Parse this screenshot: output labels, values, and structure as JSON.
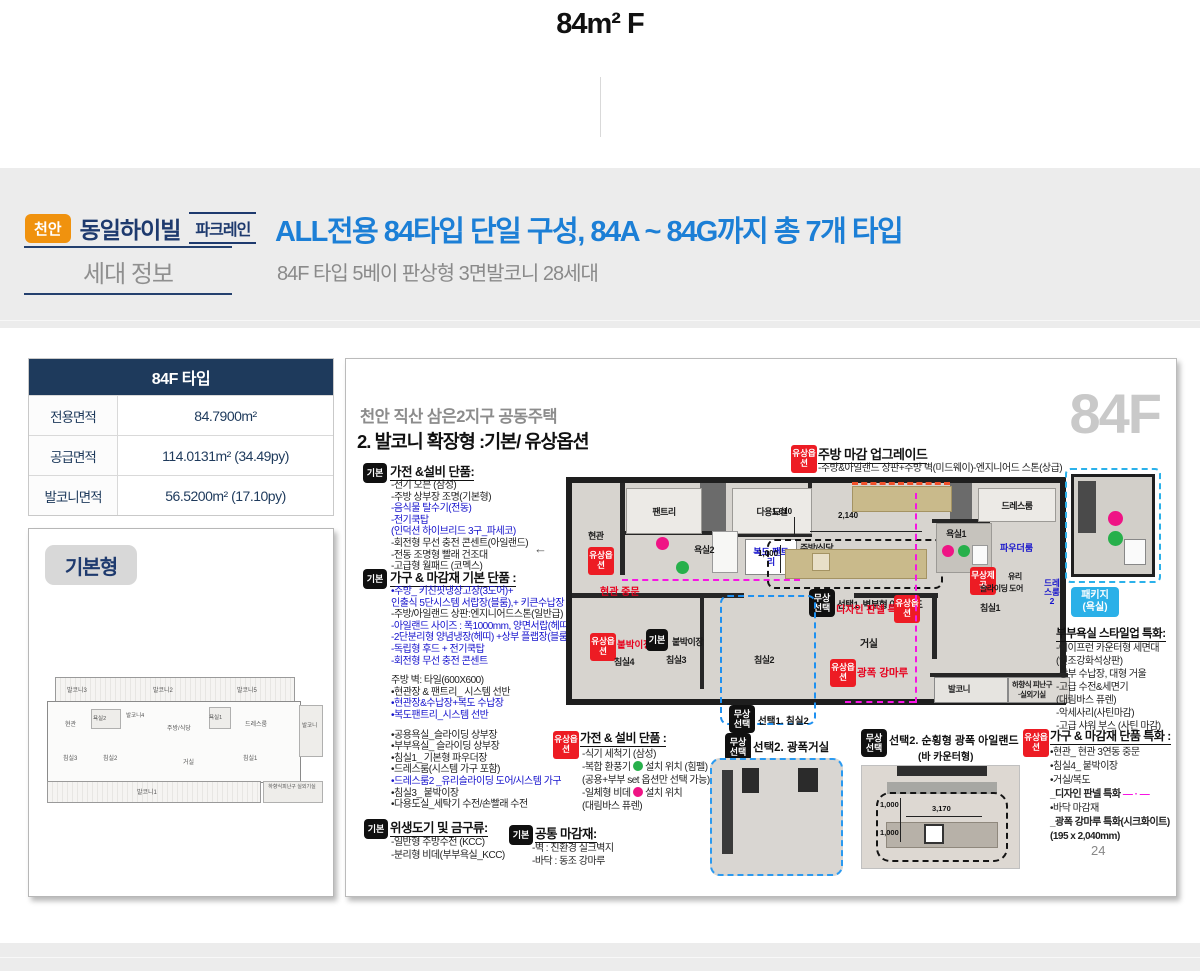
{
  "page": {
    "title": "84m² F"
  },
  "header": {
    "region_badge": "천안",
    "brand": "동일하이빌",
    "brand_tag": "파크레인",
    "section_label": "세대 정보",
    "headline": "ALL전용 84타입 단일 구성, 84A ~ 84G까지 총 7개 타입",
    "subheadline": "84F 타입 5베이 판상형 3면발코니 28세대"
  },
  "spec": {
    "title": "84F 타입",
    "rows": [
      {
        "label": "전용면적",
        "value": "84.7900m²"
      },
      {
        "label": "공급면적",
        "value": "114.0131m² (34.49py)"
      },
      {
        "label": "발코니면적",
        "value": "56.5200m² (17.10py)"
      }
    ]
  },
  "mini": {
    "tag": "기본형",
    "labels": {
      "balcony3": "발코니3",
      "balcony2": "발코니2",
      "balcony5": "발코니5",
      "entrance": "현관",
      "bath2": "욕실2",
      "balcony4": "발코니4",
      "kitchen": "주방/식당",
      "bath1": "욕실1",
      "dress": "드레스룸",
      "balcony_side": "발코니",
      "bed3": "침실3",
      "bed2": "침실2",
      "living": "거실",
      "bed1": "침실1",
      "balcony1": "발코니1",
      "escape": "하향식피난구 실외기실"
    }
  },
  "badges": {
    "basic": "기본",
    "paid": "유상옵션",
    "free_select": "무상선택",
    "free_provide": "무상제공",
    "package_line1": "패키지",
    "package_line2": "(욕실)"
  },
  "panel": {
    "project": "천안 직산 삼은2지구 공동주택",
    "section": "2. 발코니 확장형 :기본/ 유상옵션",
    "watermark": "84F",
    "page_no": "24",
    "group1": {
      "title": "가전 &설비 단품:",
      "items": [
        "-전기 오븐 (삼성)",
        "-주방 상부장 조명(기본형)",
        "-음식물 탈수기(전동)",
        "-전기쿡탑",
        "(인덕션 하이브리드 3구_파세코)",
        "-회전형 무선 충전 콘센트(아일랜드)",
        "-전동 조명형 빨래 건조대",
        "-고급형 월패드 (코멕스)"
      ]
    },
    "group2": {
      "title": "가구 & 마감재 기본 단품 :",
      "items": [
        "•주방_ 키친핏냉장고장(3도어)+",
        "인출식 5단시스템 서랍장(블룸),+ 키큰수납장",
        "-주방/아일랜드 상판:엔지니어드스톤(일반급)",
        "-아일랜드 사이즈 : 폭1000mm, 양면서랍(헤띠)",
        "-2단분리형 양념냉장(헤띠) +상부 플랩장(블룸)",
        "-독립형 후드 + 전기쿡탑",
        "-회전형 무선 충전 콘센트",
        "주방 벽: 타일(600X600)",
        "•현관장 & 팬트리_ 시스템 선반",
        "•현관장&수납장+복도 수납장",
        "•복도팬트리_시스템 선반",
        "•공용욕실_슬라이딩 상부장",
        "•부부욕실_ 슬라이딩 상부장",
        "•침실1_ 기본형 파우더장",
        "•드레스룸(시스템 가구 포함)",
        "•드레스룸2 _유리슬라이딩 도어/시스템 가구",
        "•침실3_ 붙박이장",
        "•다용도실_세탁기 수전/손빨래 수전"
      ]
    },
    "group3": {
      "title": "위생도기 및 금구류:",
      "items": [
        "-일반형 주방수전 (KCC)",
        "-분리형 비데(부부욕실_KCC)"
      ]
    },
    "group4": {
      "title": "공통 마감재:",
      "items": [
        "-벽 : 친환경 실크벽지",
        "-바닥 : 동조 강마루"
      ]
    },
    "kitchen_upgrade": {
      "title": "주방 마감 업그레이드",
      "desc": "-주방&아일랜드 상판+주방 벽(미드웨이)-엔지니어드 스톤(상급)"
    },
    "plan": {
      "rooms": {
        "pantry": "팬트리",
        "utility": "다용도실",
        "entrance": "현관",
        "bath2": "욕실2",
        "corridor_pantry": "복도 팬트리",
        "kitchen": "주방/식당",
        "bath1": "욕실1",
        "powder": "파우더룸",
        "dress": "드레스룸",
        "dress2": "드레스룸2",
        "bed1": "침실1",
        "bed2": "침실2",
        "bed3": "침실3",
        "bed4": "침실4",
        "living": "거실",
        "balcony": "발코니",
        "escape1": "하향식 피난구",
        "escape2": "·실외기실"
      },
      "labels": {
        "entrance_door": "현관 중문",
        "builtin_paid": "붙박이장",
        "builtin_basic": "붙박이장",
        "design_panel": "디자인 판넬 특화",
        "wide_floor": "광폭 강마루",
        "glass1": "유리",
        "glass2": "슬라이딩 도어",
        "select1_island": "선택1.  벽부형 아일랜드",
        "select1_bed2": "선택1. 침실2"
      },
      "dims": {
        "d1": "1,010",
        "d2": "2,140",
        "d3": "1,000"
      }
    },
    "bath_pkg": {
      "title": "부부욕실 스타일업 특화:",
      "items": [
        "-에이프런 카운터형 세면대",
        "(인조강화석상판)",
        "-상부 수납장, 대형 거울",
        "-고급 수전&세면기",
        "(대림바스 퓨렌)",
        "-악세사리(사틴마감)",
        "-고급 샤워 부스 (사틴 마감)"
      ]
    },
    "appliance_opt": {
      "title": "가전 & 설비 단품 :",
      "item1": "-식기 세척기 (삼성)",
      "item2_pre": "-복합 환풍기",
      "item2_post": "설치 위치 (힘펠)",
      "item3": "(공용+부부 set 옵션만 선택 가능)",
      "item4_pre": "-일체형 비데",
      "item4_post": "설치 위치",
      "item5": "(대림바스 퓨렌)"
    },
    "select2_living": {
      "label": "선택2. 광폭거실"
    },
    "select2_island": {
      "label": "선택2. 순횡형 광폭 아일랜드",
      "label2": "(바 카운터형)",
      "dim_w": "3,170",
      "dim_h1": "1,000",
      "dim_h2": "1,000"
    },
    "furniture_opt": {
      "title": "가구 & 마감재 단품 특화 :",
      "items": [
        "•현관_ 현관 3연동 중문",
        "•침실4_ 붙박이장",
        "•거실/복도",
        "_디자인 판넬 특화",
        "•바닥 마감재",
        "_광폭 강마루 특화(시크화이트)",
        "(195 x 2,040mm)"
      ],
      "sample": "— · —"
    }
  }
}
